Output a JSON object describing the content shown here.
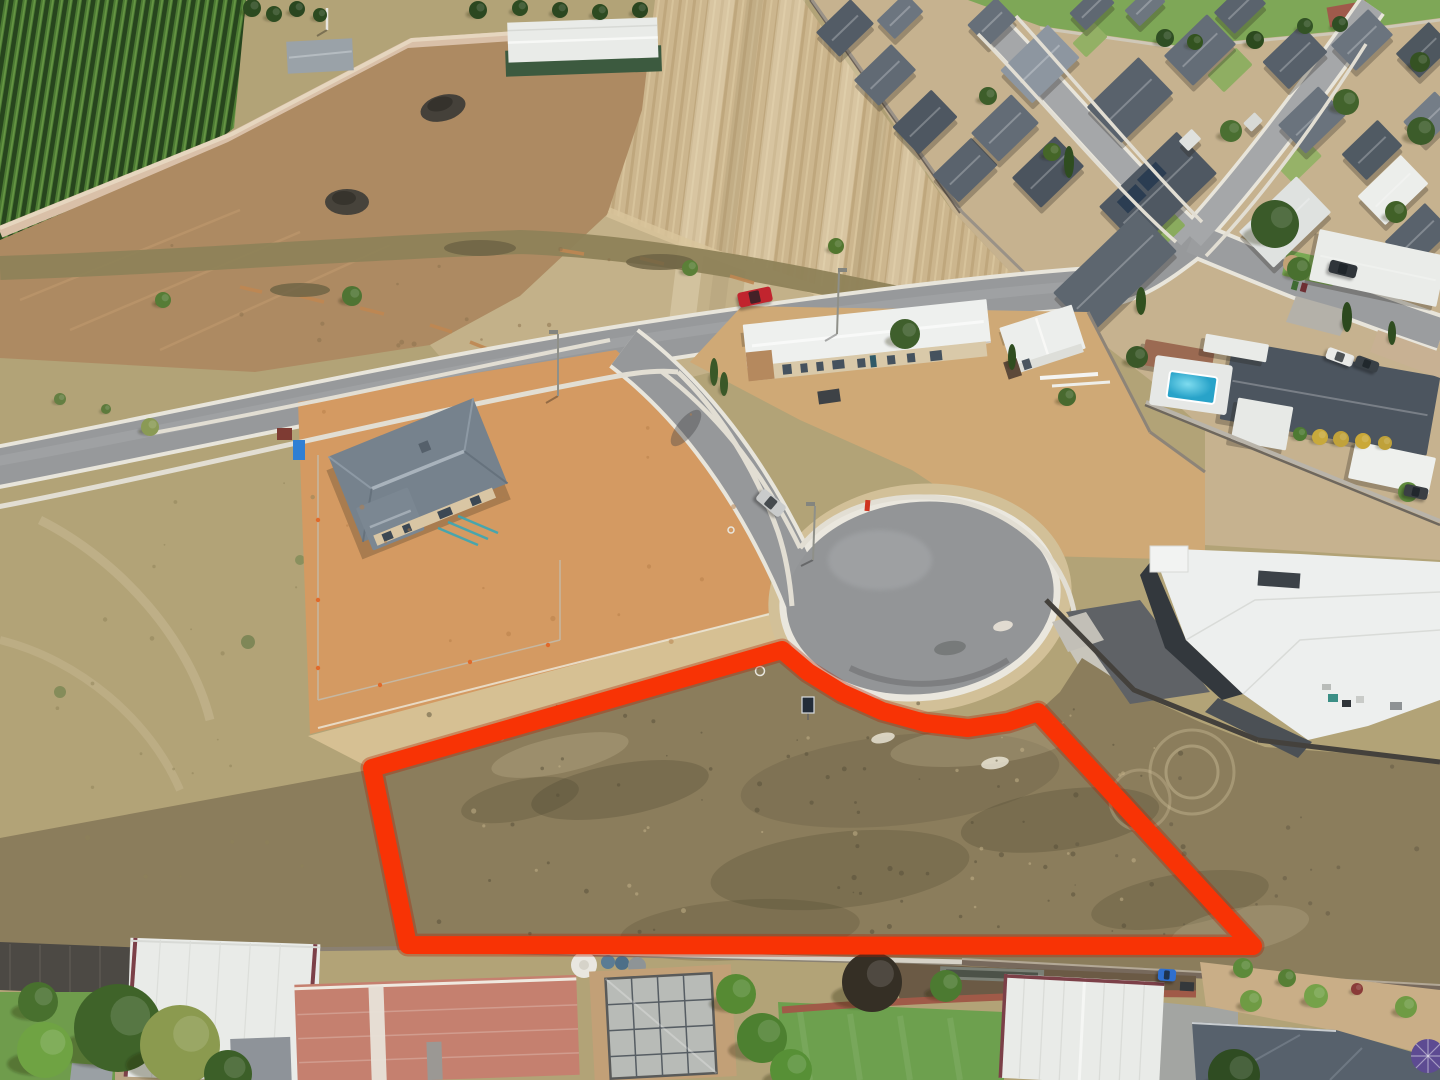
{
  "image": {
    "kind": "aerial-drone-photo",
    "description": "Aerial drone photo of a vacant residential allotment outlined in thick red, fronting a cul-de-sac in a new housing estate, bordered by vineyard, harvested paddocks, new builds under construction and established suburban backyards",
    "width": 1440,
    "height": 1080
  },
  "palette": {
    "outline_red": "#f83305",
    "outline_halo": "#b02104",
    "dry_grass": "#b2a377",
    "lot_grass": "#8b7d5c",
    "vineyard_green": "#3f6a2b",
    "crop_stubble": "#ccb68e",
    "bare_dirt": "#ad8a62",
    "construction_dirt": "#d49a62",
    "sand": "#d6c093",
    "asphalt": "#97999b",
    "culdesac_asphalt": "#939597",
    "kerb_concrete": "#e8e5db",
    "footpath": "#e2ded3",
    "estate_yard": "#c6b28f",
    "lawn_green": "#6da04e",
    "pool_water": "#3fc0dc",
    "salmon_roof": "#c5806f",
    "white_roof": "#edefee",
    "dark_roof": "#4c555f"
  },
  "lot_outline": {
    "color": "#f83305",
    "halo_color": "#b02104",
    "stroke_width": 18,
    "points": [
      [
        372,
        768
      ],
      [
        782,
        650
      ],
      [
        808,
        672
      ],
      [
        842,
        693
      ],
      [
        882,
        711
      ],
      [
        925,
        723
      ],
      [
        968,
        728
      ],
      [
        1008,
        722
      ],
      [
        1038,
        712
      ],
      [
        1253,
        946
      ],
      [
        408,
        945
      ]
    ]
  },
  "sale_sign": {
    "x": 802,
    "y": 697,
    "width": 12,
    "height": 16,
    "board_color": "#232c38",
    "frame_color": "#d8dbdf"
  },
  "pool": {
    "x": 1168,
    "y": 374,
    "width": 48,
    "height": 27,
    "rot": 8,
    "water_color": "#3fc0dc"
  },
  "estate_houses": [
    {
      "x": 845,
      "y": 28,
      "w": 48,
      "h": 34,
      "rot": -44,
      "fill": "#535c66"
    },
    {
      "x": 885,
      "y": 75,
      "w": 52,
      "h": 36,
      "rot": -44,
      "fill": "#616a74"
    },
    {
      "x": 925,
      "y": 122,
      "w": 54,
      "h": 38,
      "rot": -44,
      "fill": "#4e5761"
    },
    {
      "x": 965,
      "y": 170,
      "w": 54,
      "h": 38,
      "rot": -44,
      "fill": "#5a636d"
    },
    {
      "x": 900,
      "y": 16,
      "w": 40,
      "h": 26,
      "rot": -44,
      "fill": "#6c757f"
    },
    {
      "x": 992,
      "y": 22,
      "w": 40,
      "h": 30,
      "rot": -44,
      "fill": "#666f79"
    },
    {
      "x": 1040,
      "y": 64,
      "w": 66,
      "h": 46,
      "rot": -44,
      "fill": "#8d96a0"
    },
    {
      "x": 1130,
      "y": 100,
      "w": 72,
      "h": 50,
      "rot": -44,
      "fill": "#59626c"
    },
    {
      "x": 1200,
      "y": 50,
      "w": 60,
      "h": 42,
      "rot": -44,
      "fill": "#646d77"
    },
    {
      "x": 1295,
      "y": 57,
      "w": 54,
      "h": 38,
      "rot": -44,
      "fill": "#57606a"
    },
    {
      "x": 1362,
      "y": 40,
      "w": 52,
      "h": 36,
      "rot": -44,
      "fill": "#6b747e"
    },
    {
      "x": 1424,
      "y": 50,
      "w": 46,
      "h": 34,
      "rot": -44,
      "fill": "#4e575f"
    },
    {
      "x": 1005,
      "y": 128,
      "w": 56,
      "h": 40,
      "rot": -44,
      "fill": "#636c76"
    },
    {
      "x": 1048,
      "y": 172,
      "w": 60,
      "h": 42,
      "rot": -44,
      "fill": "#4b545e"
    },
    {
      "x": 1158,
      "y": 190,
      "w": 108,
      "h": 58,
      "rot": -44,
      "fill": "#4f5862"
    },
    {
      "x": 1115,
      "y": 272,
      "w": 118,
      "h": 56,
      "rot": -44,
      "fill": "#5d666f"
    },
    {
      "x": 1285,
      "y": 222,
      "w": 80,
      "h": 50,
      "rot": -44,
      "fill": "#dfe2e0"
    },
    {
      "x": 1393,
      "y": 190,
      "w": 60,
      "h": 40,
      "rot": -44,
      "fill": "#eceeeb"
    },
    {
      "x": 1240,
      "y": 8,
      "w": 44,
      "h": 30,
      "rot": -44,
      "fill": "#5a636d"
    },
    {
      "x": 1312,
      "y": 120,
      "w": 56,
      "h": 40,
      "rot": -44,
      "fill": "#6a737d"
    },
    {
      "x": 1372,
      "y": 150,
      "w": 50,
      "h": 36,
      "rot": -44,
      "fill": "#505a63"
    },
    {
      "x": 1430,
      "y": 118,
      "w": 44,
      "h": 32,
      "rot": -44,
      "fill": "#747d87"
    },
    {
      "x": 1092,
      "y": 8,
      "w": 40,
      "h": 24,
      "rot": -44,
      "fill": "#5f6872"
    },
    {
      "x": 1145,
      "y": 6,
      "w": 36,
      "h": 22,
      "rot": -44,
      "fill": "#6d767f"
    },
    {
      "x": 1418,
      "y": 236,
      "w": 56,
      "h": 38,
      "rot": -44,
      "fill": "#59626c"
    },
    {
      "x": 1190,
      "y": 140,
      "w": 18,
      "h": 14,
      "rot": -44,
      "fill": "#dfe1de",
      "ridge": false
    },
    {
      "x": 1253,
      "y": 122,
      "w": 16,
      "h": 12,
      "rot": -44,
      "fill": "#d8dad6",
      "ridge": false
    },
    {
      "x": 1378,
      "y": 268,
      "w": 130,
      "h": 52,
      "rot": 12,
      "fill": "#eaece9"
    },
    {
      "x": 1330,
      "y": 398,
      "w": 210,
      "h": 80,
      "rot": 10,
      "fill": "#4c555f"
    },
    {
      "x": 1262,
      "y": 424,
      "w": 56,
      "h": 44,
      "rot": 10,
      "fill": "#e7e9e6",
      "ridge": false
    },
    {
      "x": 1392,
      "y": 468,
      "w": 82,
      "h": 38,
      "rot": 12,
      "fill": "#eef0ed",
      "ridge": false
    },
    {
      "x": 1178,
      "y": 358,
      "w": 70,
      "h": 26,
      "rot": 10,
      "fill": "#9b6a52",
      "ridge": false
    },
    {
      "x": 1236,
      "y": 348,
      "w": 64,
      "h": 18,
      "rot": 10,
      "fill": "#e9ebe8",
      "ridge": false
    }
  ],
  "lawn_patches": [
    {
      "x": 1230,
      "y": 70,
      "w": 40,
      "h": 24,
      "rot": -44,
      "fill": "#8fae62"
    },
    {
      "x": 1090,
      "y": 40,
      "w": 30,
      "h": 20,
      "rot": -44,
      "fill": "#93b065"
    },
    {
      "x": 1160,
      "y": 232,
      "w": 46,
      "h": 26,
      "rot": -44,
      "fill": "#8aab5e"
    },
    {
      "x": 1300,
      "y": 162,
      "w": 40,
      "h": 22,
      "rot": -44,
      "fill": "#96b268"
    },
    {
      "x": 1310,
      "y": 268,
      "w": 52,
      "h": 26,
      "rot": 12,
      "fill": "#79a853"
    }
  ],
  "trees": [
    {
      "x": 905,
      "y": 334,
      "r": 15,
      "c": "#3f5f2c"
    },
    {
      "x": 1275,
      "y": 224,
      "r": 24,
      "c": "#3a5a29"
    },
    {
      "x": 1299,
      "y": 269,
      "r": 12,
      "c": "#49702f"
    },
    {
      "x": 1346,
      "y": 102,
      "r": 13,
      "c": "#42632c"
    },
    {
      "x": 1421,
      "y": 131,
      "r": 14,
      "c": "#3c5c2a"
    },
    {
      "x": 1231,
      "y": 131,
      "r": 11,
      "c": "#4a6f31"
    },
    {
      "x": 1052,
      "y": 152,
      "r": 9,
      "c": "#456628"
    },
    {
      "x": 988,
      "y": 96,
      "r": 9,
      "c": "#3d5e2a"
    },
    {
      "x": 1396,
      "y": 212,
      "r": 11,
      "c": "#416128"
    },
    {
      "x": 1137,
      "y": 357,
      "r": 11,
      "c": "#3a5828"
    },
    {
      "x": 1067,
      "y": 397,
      "r": 9,
      "c": "#486a2f"
    },
    {
      "x": 1420,
      "y": 62,
      "r": 10,
      "c": "#355223"
    },
    {
      "x": 690,
      "y": 268,
      "r": 8,
      "c": "#5b8038"
    },
    {
      "x": 836,
      "y": 246,
      "r": 8,
      "c": "#52762f"
    },
    {
      "x": 352,
      "y": 296,
      "r": 10,
      "c": "#4f7433"
    },
    {
      "x": 163,
      "y": 300,
      "r": 8,
      "c": "#567c36"
    },
    {
      "x": 60,
      "y": 399,
      "r": 6,
      "c": "#647f42"
    },
    {
      "x": 106,
      "y": 409,
      "r": 5,
      "c": "#5d7a3c"
    },
    {
      "x": 150,
      "y": 427,
      "r": 9,
      "c": "#8a9a55"
    },
    {
      "x": 1069,
      "y": 162,
      "r": 5,
      "ry": 16,
      "c": "#2f4d20"
    },
    {
      "x": 1141,
      "y": 301,
      "r": 5,
      "ry": 14,
      "c": "#31501f"
    },
    {
      "x": 1012,
      "y": 357,
      "r": 4,
      "ry": 13,
      "c": "#2f4d20"
    },
    {
      "x": 1347,
      "y": 317,
      "r": 5,
      "ry": 15,
      "c": "#2c491e"
    },
    {
      "x": 1392,
      "y": 333,
      "r": 4,
      "ry": 12,
      "c": "#2f4d20"
    },
    {
      "x": 714,
      "y": 372,
      "r": 4,
      "ry": 14,
      "c": "#3a5828"
    },
    {
      "x": 724,
      "y": 384,
      "r": 4,
      "ry": 12,
      "c": "#3a5828"
    },
    {
      "x": 252,
      "y": 8,
      "r": 9,
      "c": "#2c4a20"
    },
    {
      "x": 274,
      "y": 14,
      "r": 8,
      "c": "#2e4c21"
    },
    {
      "x": 297,
      "y": 9,
      "r": 8,
      "c": "#2a4620"
    },
    {
      "x": 320,
      "y": 15,
      "r": 7,
      "c": "#2c4a20"
    },
    {
      "x": 478,
      "y": 10,
      "r": 9,
      "c": "#2b4720"
    },
    {
      "x": 520,
      "y": 8,
      "r": 8,
      "c": "#2e4c22"
    },
    {
      "x": 560,
      "y": 10,
      "r": 8,
      "c": "#2b4720"
    },
    {
      "x": 600,
      "y": 12,
      "r": 8,
      "c": "#2d4b21"
    },
    {
      "x": 640,
      "y": 10,
      "r": 8,
      "c": "#2a4620"
    },
    {
      "x": 1165,
      "y": 38,
      "r": 9,
      "c": "#2f4e23"
    },
    {
      "x": 1195,
      "y": 42,
      "r": 8,
      "c": "#33531f"
    },
    {
      "x": 1255,
      "y": 40,
      "r": 9,
      "c": "#2c4a1e"
    },
    {
      "x": 1305,
      "y": 26,
      "r": 8,
      "c": "#335325"
    },
    {
      "x": 1340,
      "y": 24,
      "r": 8,
      "c": "#2f4e23"
    },
    {
      "x": 118,
      "y": 1028,
      "r": 44,
      "c": "#3f6329"
    },
    {
      "x": 38,
      "y": 1002,
      "r": 20,
      "c": "#48702e"
    },
    {
      "x": 45,
      "y": 1050,
      "r": 28,
      "c": "#6fa343"
    },
    {
      "x": 180,
      "y": 1045,
      "r": 40,
      "c": "#8b9a4f"
    },
    {
      "x": 228,
      "y": 1074,
      "r": 24,
      "c": "#3c5f28"
    },
    {
      "x": 736,
      "y": 994,
      "r": 20,
      "c": "#568a33"
    },
    {
      "x": 762,
      "y": 1038,
      "r": 25,
      "c": "#4d8030"
    },
    {
      "x": 791,
      "y": 1070,
      "r": 21,
      "c": "#579036"
    },
    {
      "x": 872,
      "y": 982,
      "r": 30,
      "c": "#352f25"
    },
    {
      "x": 946,
      "y": 986,
      "r": 16,
      "c": "#4c7a31"
    },
    {
      "x": 1234,
      "y": 1075,
      "r": 26,
      "c": "#2f4c22"
    },
    {
      "x": 1243,
      "y": 968,
      "r": 10,
      "c": "#5c8a3a"
    },
    {
      "x": 1287,
      "y": 978,
      "r": 9,
      "c": "#567f35"
    },
    {
      "x": 1251,
      "y": 1001,
      "r": 11,
      "c": "#6f9b44"
    },
    {
      "x": 1316,
      "y": 996,
      "r": 12,
      "c": "#75a249"
    },
    {
      "x": 1406,
      "y": 1007,
      "r": 11,
      "c": "#6f9b44"
    },
    {
      "x": 1357,
      "y": 989,
      "r": 6,
      "c": "#8a3b38"
    },
    {
      "x": 1408,
      "y": 492,
      "r": 10,
      "c": "#5e8a3c"
    },
    {
      "x": 1300,
      "y": 434,
      "r": 7,
      "c": "#4e7a33"
    },
    {
      "x": 1320,
      "y": 437,
      "r": 8,
      "c": "#c8a93c"
    },
    {
      "x": 1341,
      "y": 439,
      "r": 8,
      "c": "#c1a23a"
    },
    {
      "x": 1363,
      "y": 441,
      "r": 8,
      "c": "#caa838"
    },
    {
      "x": 1385,
      "y": 443,
      "r": 7,
      "c": "#bfa139"
    }
  ],
  "cars": [
    {
      "x": 755,
      "y": 297,
      "w": 34,
      "h": 15,
      "rot": -12,
      "c": "#c1242e",
      "name": "red-car"
    },
    {
      "x": 771,
      "y": 503,
      "w": 30,
      "h": 14,
      "rot": 40,
      "c": "#c9cbcb",
      "name": "silver-car"
    },
    {
      "x": 1340,
      "y": 357,
      "w": 28,
      "h": 12,
      "rot": 20,
      "c": "#e9eae8",
      "name": "white-car"
    },
    {
      "x": 1367,
      "y": 364,
      "w": 24,
      "h": 11,
      "rot": 20,
      "c": "#394046",
      "name": "dark-car"
    },
    {
      "x": 1343,
      "y": 269,
      "w": 28,
      "h": 13,
      "rot": 14,
      "c": "#30353a",
      "name": "suv"
    },
    {
      "x": 1416,
      "y": 492,
      "w": 24,
      "h": 12,
      "rot": 12,
      "c": "#3a3f44",
      "name": "ute"
    },
    {
      "x": 1167,
      "y": 975,
      "w": 18,
      "h": 12,
      "rot": 4,
      "c": "#2e6fd0",
      "name": "blue-mower"
    }
  ]
}
